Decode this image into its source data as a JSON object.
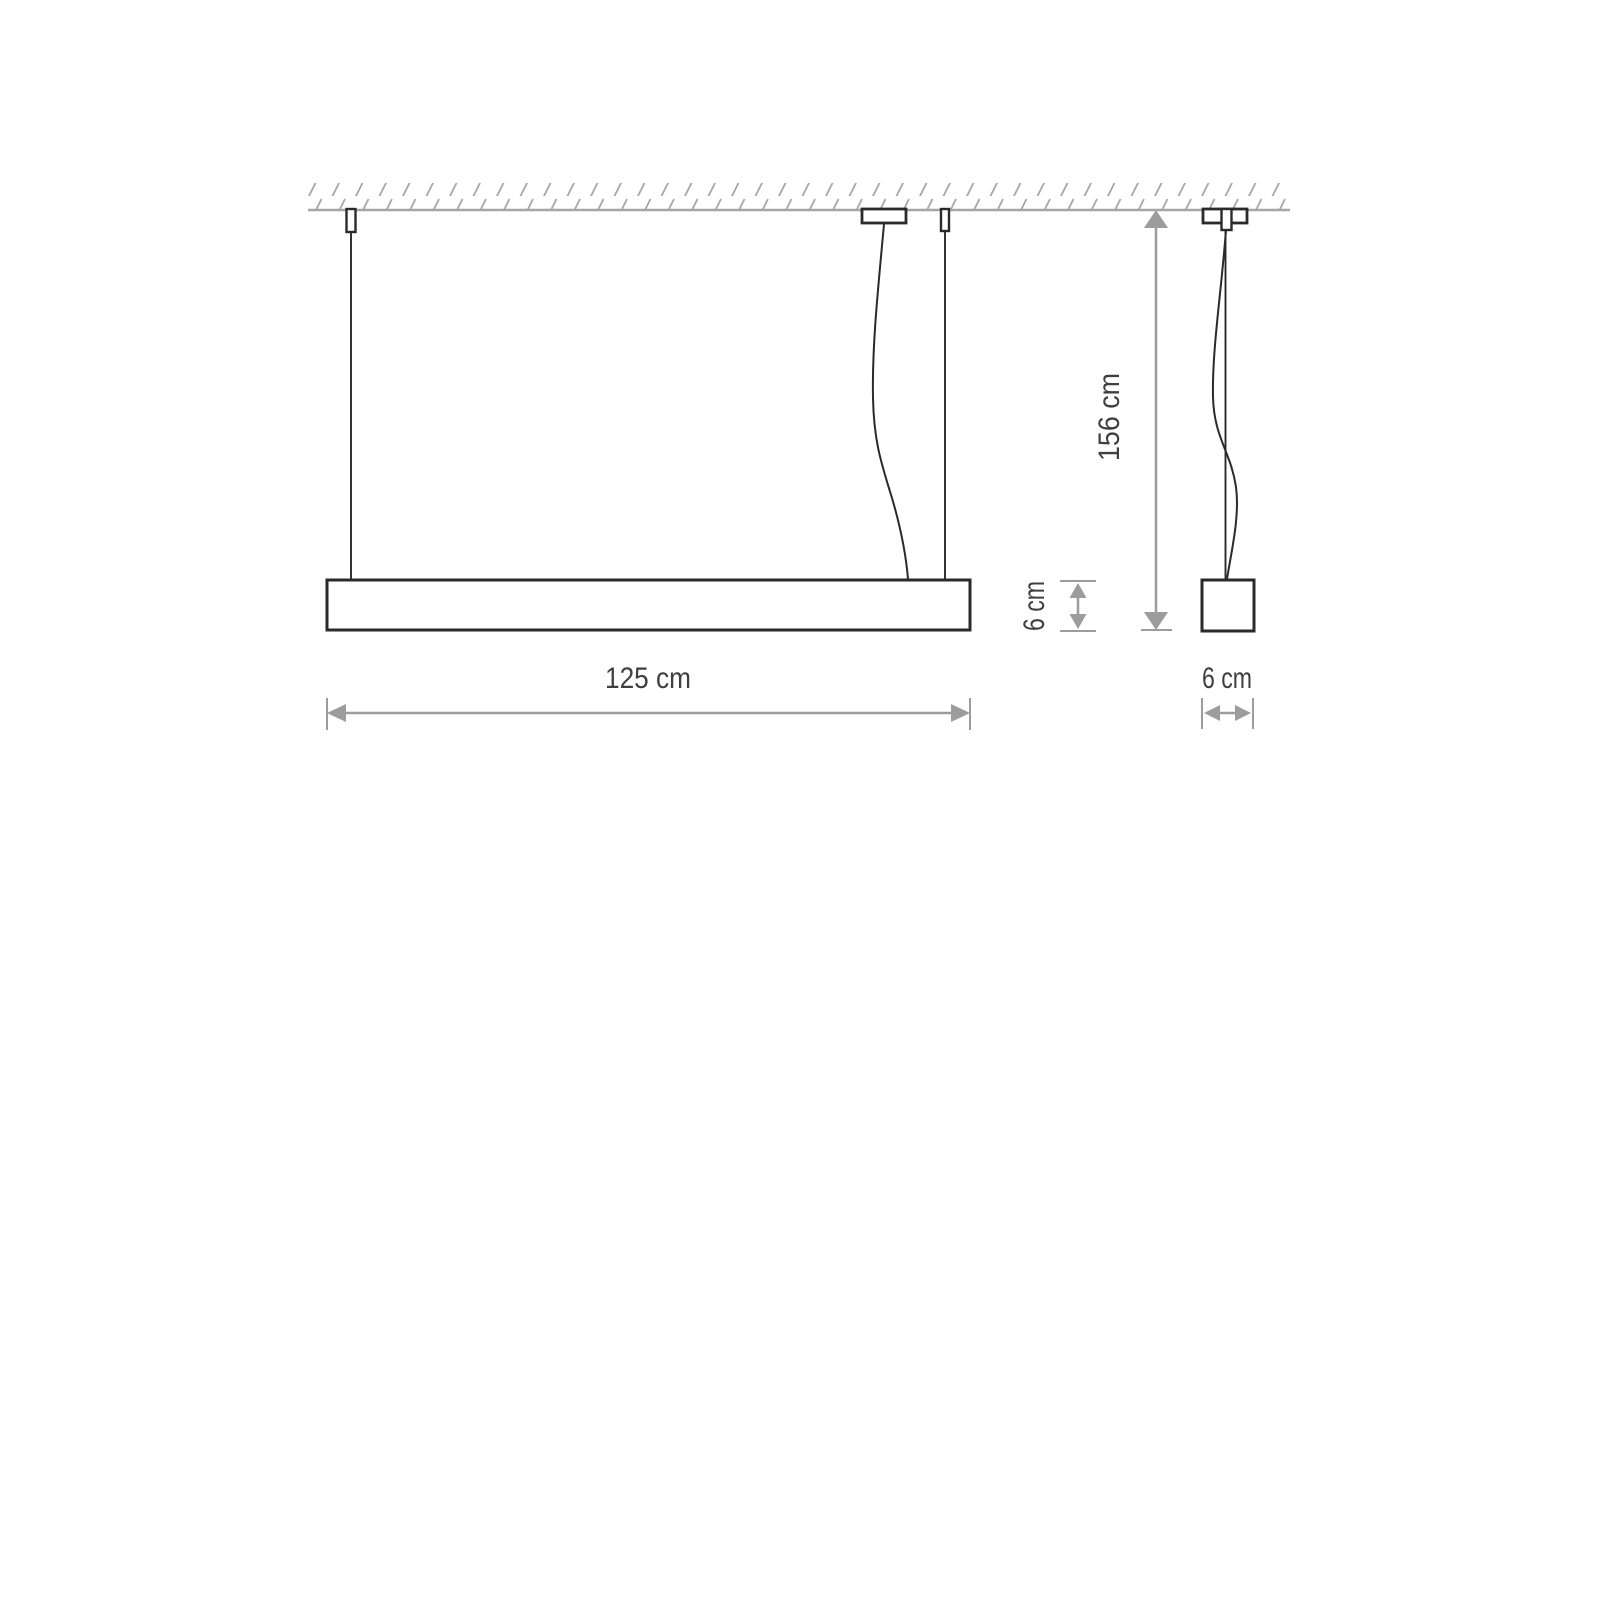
{
  "diagram": {
    "type": "technical-dimension-drawing",
    "subject": "linear-pendant-lamp",
    "views": {
      "front": "lamp profile suspended from ceiling by two wires and one power cable",
      "side": "square lamp profile suspended by wire and power cable"
    },
    "labels": {
      "width": "125 cm",
      "height": "156 cm",
      "profile_height": "6 cm",
      "profile_depth": "6 cm"
    },
    "dimensions_cm": {
      "width": 125,
      "suspension_height": 156,
      "profile_height": 6,
      "profile_depth": 6
    },
    "colors": {
      "outline": "#2a2a2a",
      "dimension": "#9c9c9c",
      "ceiling": "#a6a6a6",
      "text": "#3f3f3f",
      "background": "#ffffff"
    }
  }
}
